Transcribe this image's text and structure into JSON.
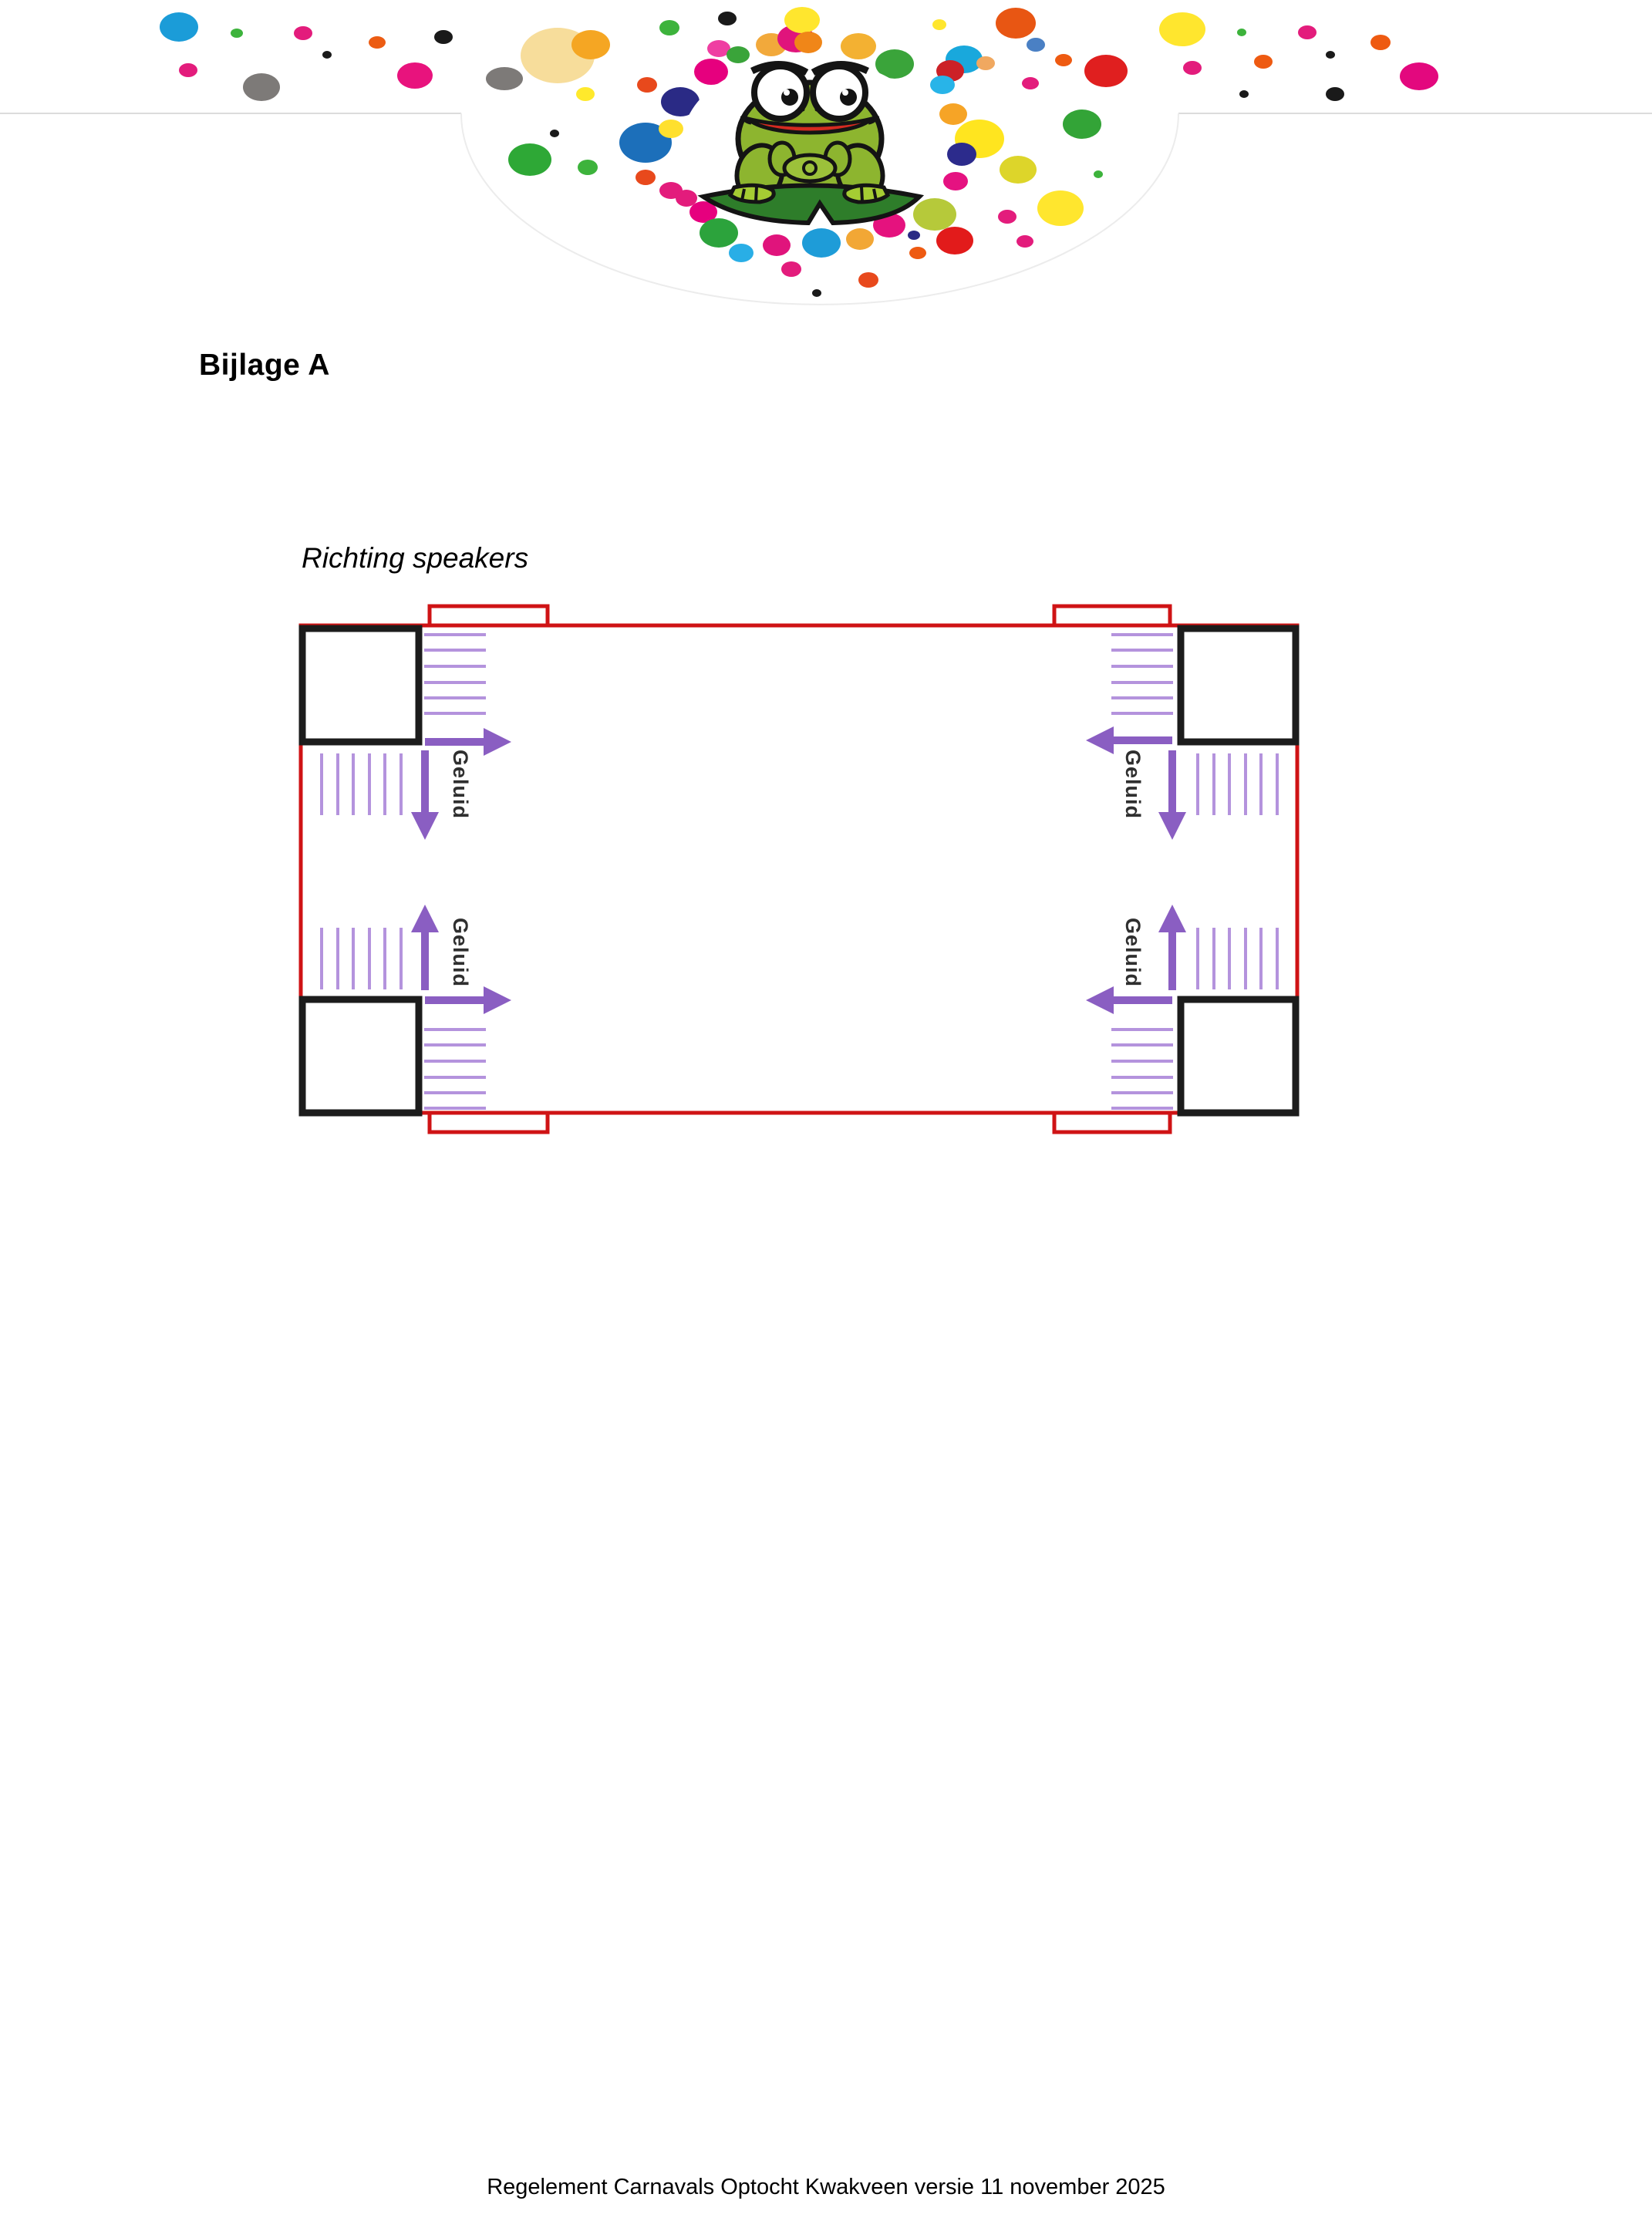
{
  "document": {
    "heading": "Bijlage A",
    "subtitle": "Richting speakers",
    "footer": "Regelement Carnavals Optocht Kwakveen versie 11 november 2025"
  },
  "header": {
    "divider_color": "#dcdcdc",
    "bulge_edge_color": "#ececec",
    "logo_name": "frog-logo",
    "frog_colors": {
      "body": "#8db52f",
      "light": "#a5cc33",
      "pad": "#2e7d2a",
      "mouth": "#d42a20",
      "outline": "#141414"
    },
    "confetti": [
      [
        232,
        35,
        25,
        19,
        "#1b9cd8"
      ],
      [
        307,
        43,
        8,
        6,
        "#3db33c"
      ],
      [
        393,
        43,
        12,
        9,
        "#e31c7c"
      ],
      [
        424,
        71,
        6,
        5,
        "#1a1a1a"
      ],
      [
        489,
        55,
        11,
        8,
        "#ec5c13"
      ],
      [
        575,
        48,
        12,
        9,
        "#1a1a1a"
      ],
      [
        244,
        91,
        12,
        9,
        "#e31c7c"
      ],
      [
        339,
        113,
        24,
        18,
        "#7d7a78"
      ],
      [
        538,
        98,
        23,
        17,
        "#e8137d"
      ],
      [
        654,
        102,
        24,
        15,
        "#7d7a78"
      ],
      [
        723,
        72,
        48,
        36,
        "#f7dd9b"
      ],
      [
        766,
        58,
        25,
        19,
        "#f5a623"
      ],
      [
        759,
        122,
        12,
        9,
        "#ffe92c"
      ],
      [
        868,
        36,
        13,
        10,
        "#3db33c"
      ],
      [
        943,
        24,
        12,
        9,
        "#1a1a1a"
      ],
      [
        839,
        110,
        13,
        10,
        "#e8491c"
      ],
      [
        719,
        173,
        6,
        5,
        "#1a1a1a"
      ],
      [
        687,
        207,
        28,
        21,
        "#2ea836"
      ],
      [
        762,
        217,
        13,
        10,
        "#3db33c"
      ],
      [
        837,
        230,
        13,
        10,
        "#e8491c"
      ],
      [
        870,
        247,
        15,
        11,
        "#e31c7c"
      ],
      [
        882,
        132,
        25,
        19,
        "#2a2a85"
      ],
      [
        837,
        185,
        34,
        26,
        "#1c6fba"
      ],
      [
        870,
        167,
        16,
        12,
        "#ffe02e"
      ],
      [
        912,
        275,
        18,
        14,
        "#e6007e"
      ],
      [
        932,
        63,
        15,
        11,
        "#ef3ea2"
      ],
      [
        922,
        93,
        22,
        17,
        "#e6007e"
      ],
      [
        957,
        71,
        15,
        11,
        "#3aa43a"
      ],
      [
        1000,
        58,
        20,
        15,
        "#f2a93b"
      ],
      [
        1032,
        50,
        24,
        18,
        "#e0147c"
      ],
      [
        1040,
        26,
        23,
        17,
        "#ffe62e"
      ],
      [
        1048,
        55,
        18,
        14,
        "#f08618"
      ],
      [
        1113,
        60,
        23,
        17,
        "#f3b132"
      ],
      [
        1160,
        83,
        25,
        19,
        "#3aa43a"
      ],
      [
        1218,
        32,
        9,
        7,
        "#ffe62e"
      ],
      [
        1317,
        30,
        26,
        20,
        "#e85613"
      ],
      [
        1250,
        77,
        24,
        18,
        "#19a8dc"
      ],
      [
        1232,
        92,
        18,
        14,
        "#cc2127"
      ],
      [
        1222,
        110,
        16,
        12,
        "#28b4e8"
      ],
      [
        1278,
        82,
        12,
        9,
        "#f0a860"
      ],
      [
        1236,
        148,
        18,
        14,
        "#f6a426"
      ],
      [
        1270,
        180,
        32,
        25,
        "#ffe51f"
      ],
      [
        1247,
        200,
        19,
        15,
        "#2c2b8c"
      ],
      [
        1239,
        235,
        16,
        12,
        "#e51281"
      ],
      [
        1212,
        278,
        28,
        21,
        "#b6c93a"
      ],
      [
        1185,
        305,
        8,
        6,
        "#2a2a85"
      ],
      [
        1238,
        312,
        24,
        18,
        "#e21b1b"
      ],
      [
        1306,
        281,
        12,
        9,
        "#e31c7c"
      ],
      [
        1375,
        270,
        30,
        23,
        "#ffe62e"
      ],
      [
        1320,
        220,
        24,
        18,
        "#ddd52a"
      ],
      [
        1403,
        161,
        25,
        19,
        "#33a437"
      ],
      [
        1424,
        226,
        6,
        5,
        "#3db33c"
      ],
      [
        1329,
        313,
        11,
        8,
        "#e31c7c"
      ],
      [
        1343,
        58,
        12,
        9,
        "#4a80c4"
      ],
      [
        1379,
        78,
        11,
        8,
        "#ee5a11"
      ],
      [
        1336,
        108,
        11,
        8,
        "#e31c7c"
      ],
      [
        1434,
        92,
        28,
        21,
        "#e01f1f"
      ],
      [
        1533,
        38,
        30,
        22,
        "#ffe62e"
      ],
      [
        1546,
        88,
        12,
        9,
        "#e31c7c"
      ],
      [
        1610,
        42,
        6,
        5,
        "#3db33c"
      ],
      [
        1695,
        42,
        12,
        9,
        "#e31c7c"
      ],
      [
        1790,
        55,
        13,
        10,
        "#ee5a11"
      ],
      [
        1725,
        71,
        6,
        5,
        "#1a1a1a"
      ],
      [
        1638,
        80,
        12,
        9,
        "#ee5a11"
      ],
      [
        1613,
        122,
        6,
        5,
        "#1a1a1a"
      ],
      [
        1731,
        122,
        12,
        9,
        "#1a1a1a"
      ],
      [
        1840,
        99,
        25,
        18,
        "#e3087e"
      ],
      [
        932,
        302,
        25,
        19,
        "#2ca33c"
      ],
      [
        961,
        328,
        16,
        12,
        "#29aee6"
      ],
      [
        1007,
        318,
        18,
        14,
        "#e0147c"
      ],
      [
        1065,
        315,
        25,
        19,
        "#1e9cd8"
      ],
      [
        1115,
        310,
        18,
        14,
        "#f2a735"
      ],
      [
        1153,
        292,
        21,
        16,
        "#e5127e"
      ],
      [
        1026,
        349,
        13,
        10,
        "#e31c7c"
      ],
      [
        1126,
        363,
        13,
        10,
        "#e8491c"
      ],
      [
        1059,
        380,
        6,
        5,
        "#1a1a1a"
      ],
      [
        890,
        257,
        14,
        11,
        "#e31c7c"
      ],
      [
        1190,
        328,
        11,
        8,
        "#ee5a11"
      ]
    ]
  },
  "diagram": {
    "sound_label": "Geluid",
    "colors": {
      "outline": "#cf1315",
      "speaker": "#1c1c1c",
      "arrow": "#8a5ec2",
      "hatch": "#b493dd",
      "label": "#2f2f2f"
    },
    "hatch_groups": [
      {
        "dir": "h",
        "from": 550,
        "to": 630,
        "at": [
          823,
          843,
          864,
          885,
          905,
          925
        ]
      },
      {
        "dir": "h",
        "from": 1441,
        "to": 1521,
        "at": [
          823,
          843,
          864,
          885,
          905,
          925
        ]
      },
      {
        "dir": "h",
        "from": 550,
        "to": 630,
        "at": [
          1335,
          1355,
          1376,
          1397,
          1417,
          1437
        ]
      },
      {
        "dir": "h",
        "from": 1441,
        "to": 1521,
        "at": [
          1335,
          1355,
          1376,
          1397,
          1417,
          1437
        ]
      },
      {
        "dir": "v",
        "from": 977,
        "to": 1057,
        "at": [
          417,
          438,
          458,
          479,
          499,
          520
        ]
      },
      {
        "dir": "v",
        "from": 1203,
        "to": 1283,
        "at": [
          417,
          438,
          458,
          479,
          499,
          520
        ]
      },
      {
        "dir": "v",
        "from": 977,
        "to": 1057,
        "at": [
          1553,
          1574,
          1594,
          1615,
          1635,
          1656
        ]
      },
      {
        "dir": "v",
        "from": 1203,
        "to": 1283,
        "at": [
          1553,
          1574,
          1594,
          1615,
          1635,
          1656
        ]
      }
    ],
    "arrows": [
      [
        551,
        962,
        663,
        962
      ],
      [
        551,
        973,
        551,
        1089
      ],
      [
        1520,
        960,
        1408,
        960
      ],
      [
        1520,
        973,
        1520,
        1089
      ],
      [
        551,
        1284,
        551,
        1173
      ],
      [
        551,
        1297,
        663,
        1297
      ],
      [
        1520,
        1284,
        1520,
        1173
      ],
      [
        1520,
        1297,
        1408,
        1297
      ]
    ]
  }
}
